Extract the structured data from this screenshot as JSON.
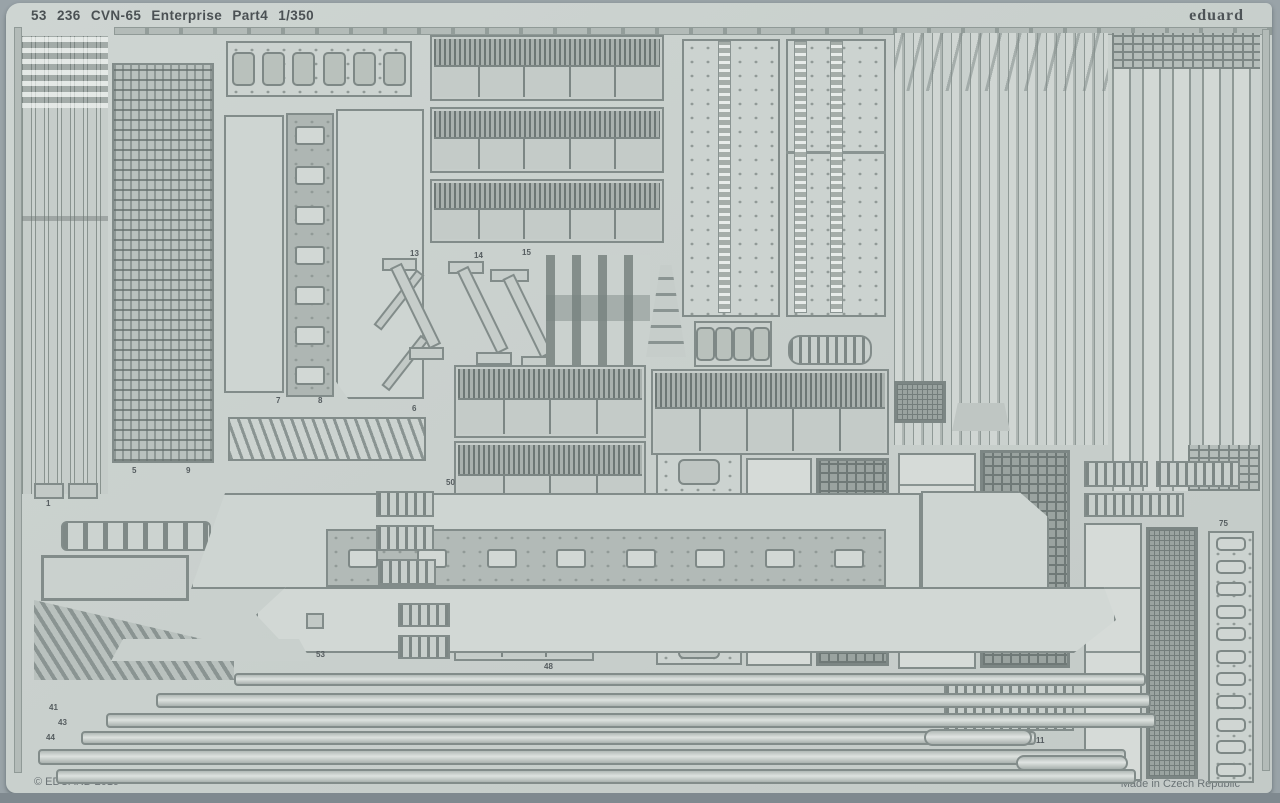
{
  "header": {
    "title": "53 236  CVN-65 Enterprise  Part4  1/350",
    "brand": "eduard"
  },
  "footer": {
    "copyright": "© EDUARD 2019",
    "made_in": "Made in Czech Republic"
  },
  "colors": {
    "backdrop": "#99a3a8",
    "sheet": "#cad1ce",
    "part_fill": "#c2c9c6",
    "part_edge": "#828c8a",
    "dark_mesh": "#6f7977",
    "text": "#4b5154"
  },
  "part_labels": [
    {
      "t": "1",
      "x": 40,
      "y": 497
    },
    {
      "t": "5",
      "x": 126,
      "y": 464
    },
    {
      "t": "9",
      "x": 180,
      "y": 464
    },
    {
      "t": "7",
      "x": 270,
      "y": 394
    },
    {
      "t": "8",
      "x": 312,
      "y": 394
    },
    {
      "t": "6",
      "x": 406,
      "y": 402
    },
    {
      "t": "13",
      "x": 404,
      "y": 247
    },
    {
      "t": "14",
      "x": 468,
      "y": 249
    },
    {
      "t": "15",
      "x": 516,
      "y": 246
    },
    {
      "t": "50",
      "x": 440,
      "y": 476
    },
    {
      "t": "48",
      "x": 538,
      "y": 660
    },
    {
      "t": "53",
      "x": 310,
      "y": 648
    },
    {
      "t": "41",
      "x": 43,
      "y": 701
    },
    {
      "t": "43",
      "x": 52,
      "y": 716
    },
    {
      "t": "44",
      "x": 40,
      "y": 731
    },
    {
      "t": "11",
      "x": 1030,
      "y": 734
    },
    {
      "t": "75",
      "x": 1213,
      "y": 517
    }
  ]
}
